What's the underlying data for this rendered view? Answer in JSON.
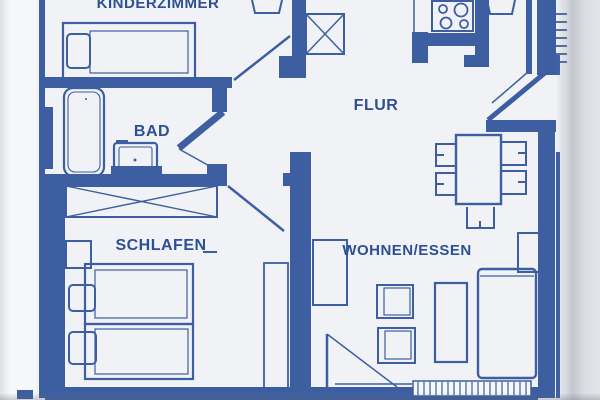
{
  "document": {
    "kind": "scanned apartment floor plan",
    "style": "blue ink line drawing on white paper"
  },
  "colors": {
    "ink": "#3d5fa1",
    "ink_dark": "#2d4f94",
    "paper": "#f6f7f9",
    "page_shadow": "#a9afbc"
  },
  "rooms": [
    {
      "id": "kinderzimmer",
      "label": "KINDERZIMMER"
    },
    {
      "id": "bad",
      "label": "BAD"
    },
    {
      "id": "flur",
      "label": "FLUR"
    },
    {
      "id": "schlafen",
      "label": "SCHLAFEN"
    },
    {
      "id": "wohnen-essen",
      "label": "WOHNEN/ESSEN"
    }
  ],
  "symbols": {
    "kinderzimmer": [
      "single-bed-icon",
      "pillow-icon",
      "chair-icon"
    ],
    "bad": [
      "bathtub-icon",
      "washbasin-icon",
      "door-swing-icon"
    ],
    "flur": [
      "stove-hob-icon",
      "kitchen-counter-icon",
      "shaft-crossed-box-icon",
      "stair-hatch-icon",
      "chair-icon"
    ],
    "schlafen": [
      "wardrobe-crossed-icon",
      "nightstand-icon",
      "double-bed-icon",
      "pillow-icon",
      "tall-cabinet-icon",
      "door-swing-icon"
    ],
    "wohnen-essen": [
      "dining-table-icon",
      "dining-chair-icon",
      "sofa-icon",
      "armchair-icon",
      "coffee-table-icon",
      "sideboard-icon",
      "shelf-icon",
      "balcony-door-swing-icon",
      "balcony-threshold-hatch-icon"
    ]
  }
}
